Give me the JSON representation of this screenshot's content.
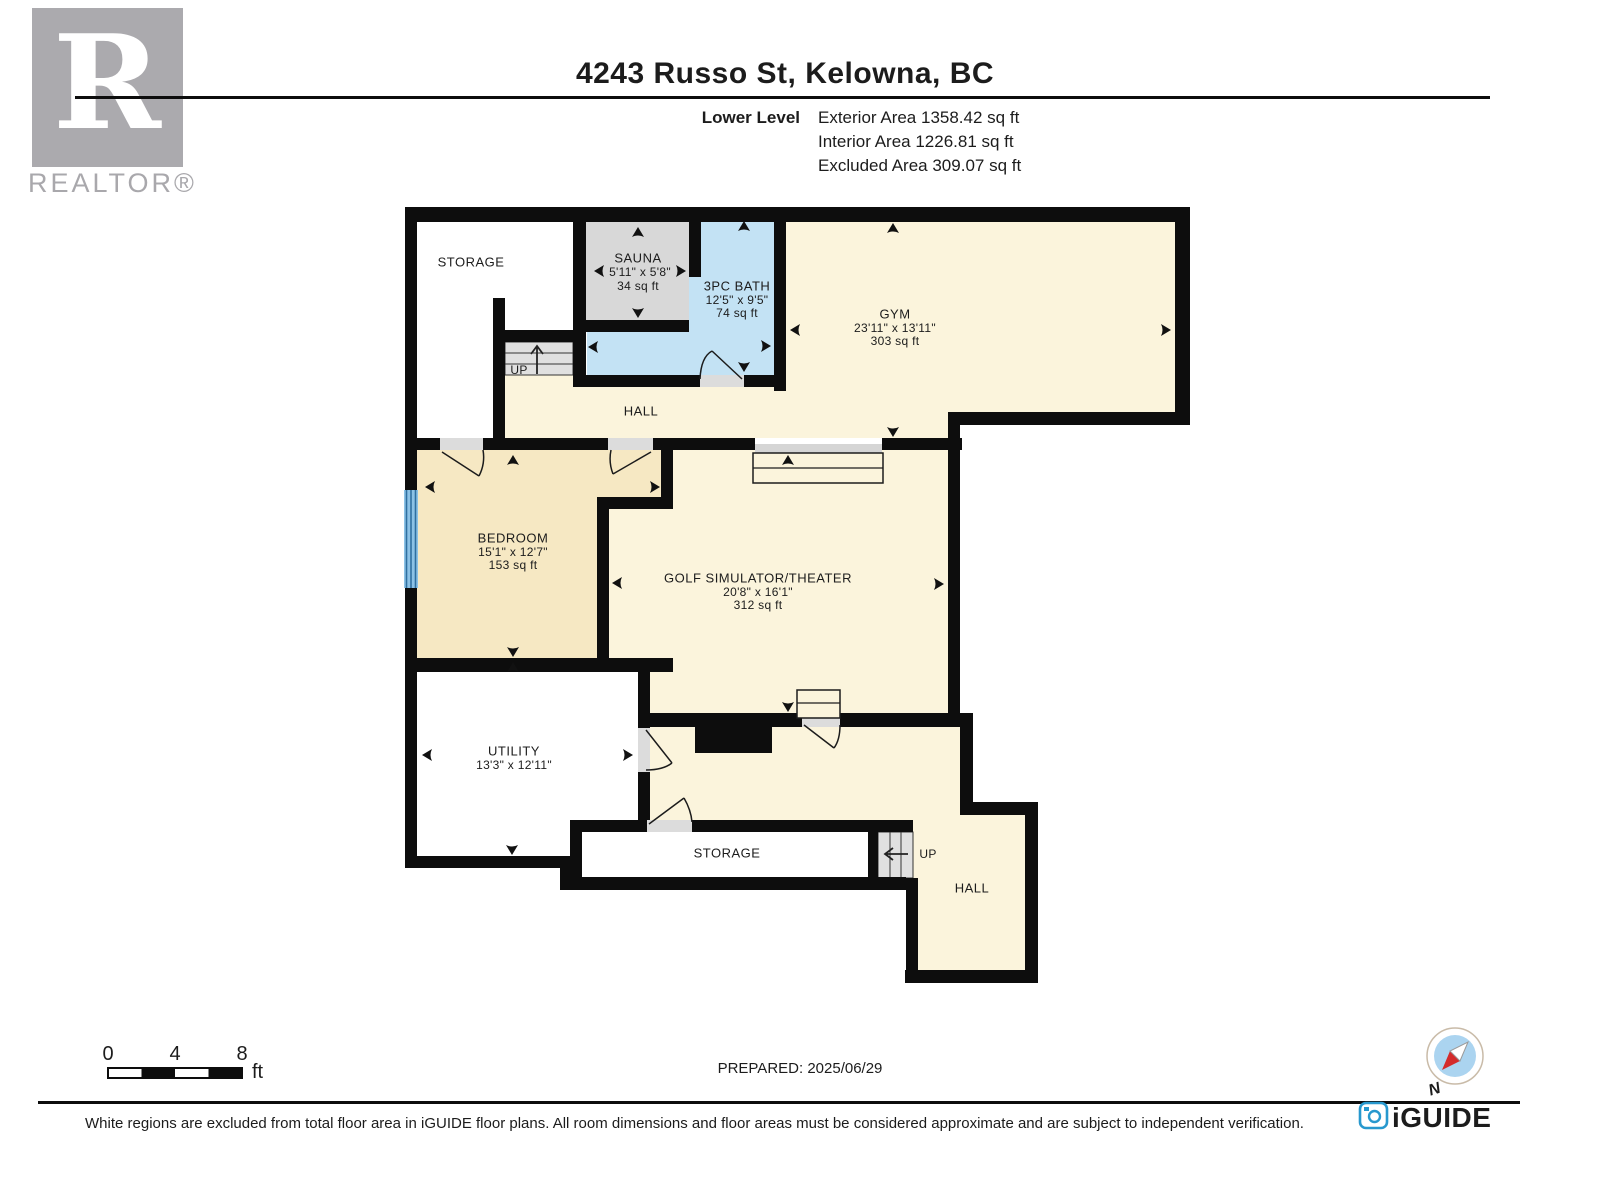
{
  "header": {
    "title": "4243 Russo St, Kelowna, BC",
    "level_label": "Lower Level",
    "exterior_area": "Exterior Area 1358.42 sq ft",
    "interior_area": "Interior Area 1226.81 sq ft",
    "excluded_area": "Excluded Area 309.07 sq ft",
    "realtor_logo": {
      "letter": "R",
      "wordmark": "REALTOR®"
    }
  },
  "rooms": {
    "storage_upper": {
      "name": "STORAGE"
    },
    "sauna": {
      "name": "SAUNA",
      "dims": "5'11\" x 5'8\"",
      "area": "34 sq ft"
    },
    "bath": {
      "name": "3PC BATH",
      "dims": "12'5\" x 9'5\"",
      "area": "74 sq ft"
    },
    "gym": {
      "name": "GYM",
      "dims": "23'11\" x 13'11\"",
      "area": "303 sq ft"
    },
    "hall_upper": {
      "name": "HALL"
    },
    "bedroom": {
      "name": "BEDROOM",
      "dims": "15'1\" x 12'7\"",
      "area": "153 sq ft"
    },
    "golf": {
      "name": "GOLF SIMULATOR/THEATER",
      "dims": "20'8\" x 16'1\"",
      "area": "312 sq ft"
    },
    "utility": {
      "name": "UTILITY",
      "dims": "13'3\" x 12'11\""
    },
    "storage_lower": {
      "name": "STORAGE"
    },
    "hall_lower": {
      "name": "HALL"
    }
  },
  "stairs": {
    "upper": "UP",
    "lower": "UP"
  },
  "footer": {
    "scale": {
      "tick0": "0",
      "tick4": "4",
      "tick8": "8",
      "unit": "ft"
    },
    "prepared": "PREPARED: 2025/06/29",
    "compass": "N",
    "disclaimer": "White regions are excluded from total floor area in iGUIDE floor plans. All room dimensions and floor areas must be considered approximate and are subject to independent verification.",
    "brand": "iGUIDE"
  },
  "colors": {
    "wall": "#0d0d0d",
    "cream": "#FBF4DC",
    "tan": "#F6E8C3",
    "bath_blue": "#C3E2F4",
    "room_gray": "#D8D8D8",
    "stair_gray": "#E0E0E0",
    "brand_blue": "#2798CE",
    "logo_gray": "#ABAAAE"
  }
}
